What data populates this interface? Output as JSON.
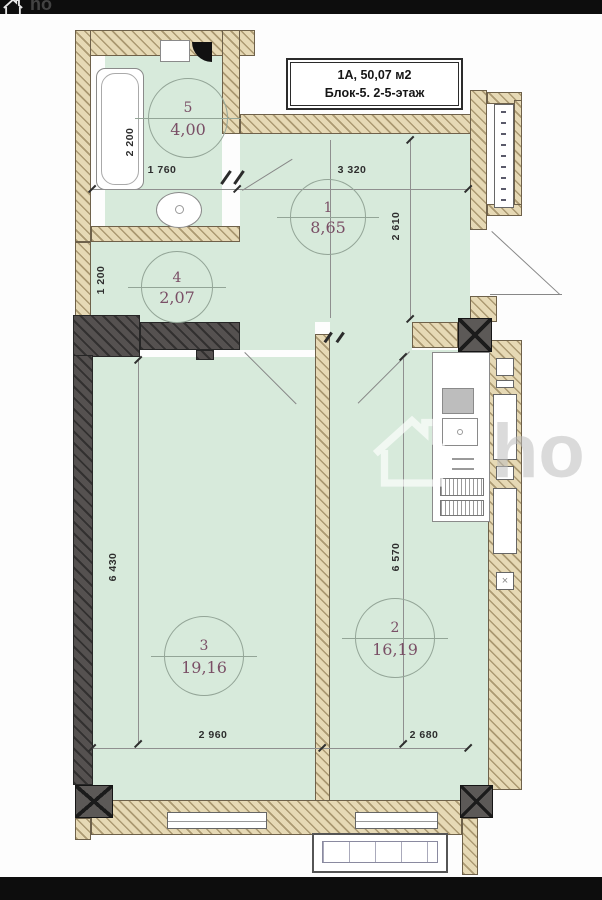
{
  "watermark": {
    "brand": "ho"
  },
  "title_block": {
    "line1": "1А, 50,07 м2",
    "line2": "Блок-5. 2-5-этаж"
  },
  "rooms": [
    {
      "number": "1",
      "area": "8,65"
    },
    {
      "number": "2",
      "area": "16,19"
    },
    {
      "number": "3",
      "area": "19,16"
    },
    {
      "number": "4",
      "area": "2,07"
    },
    {
      "number": "5",
      "area": "4,00"
    }
  ],
  "dimensions": {
    "d1760": "1 760",
    "d3320": "3 320",
    "d2200": "2 200",
    "d1200": "1 200",
    "d6430": "6 430",
    "d2610": "2 610",
    "d6570": "6 570",
    "d2960": "2 960",
    "d2680": "2 680"
  },
  "colors": {
    "room_fill": "#d7eadb",
    "wall_tan": "#e6d9b5",
    "wall_dark": "#555150",
    "label_text": "#7a4f66"
  }
}
